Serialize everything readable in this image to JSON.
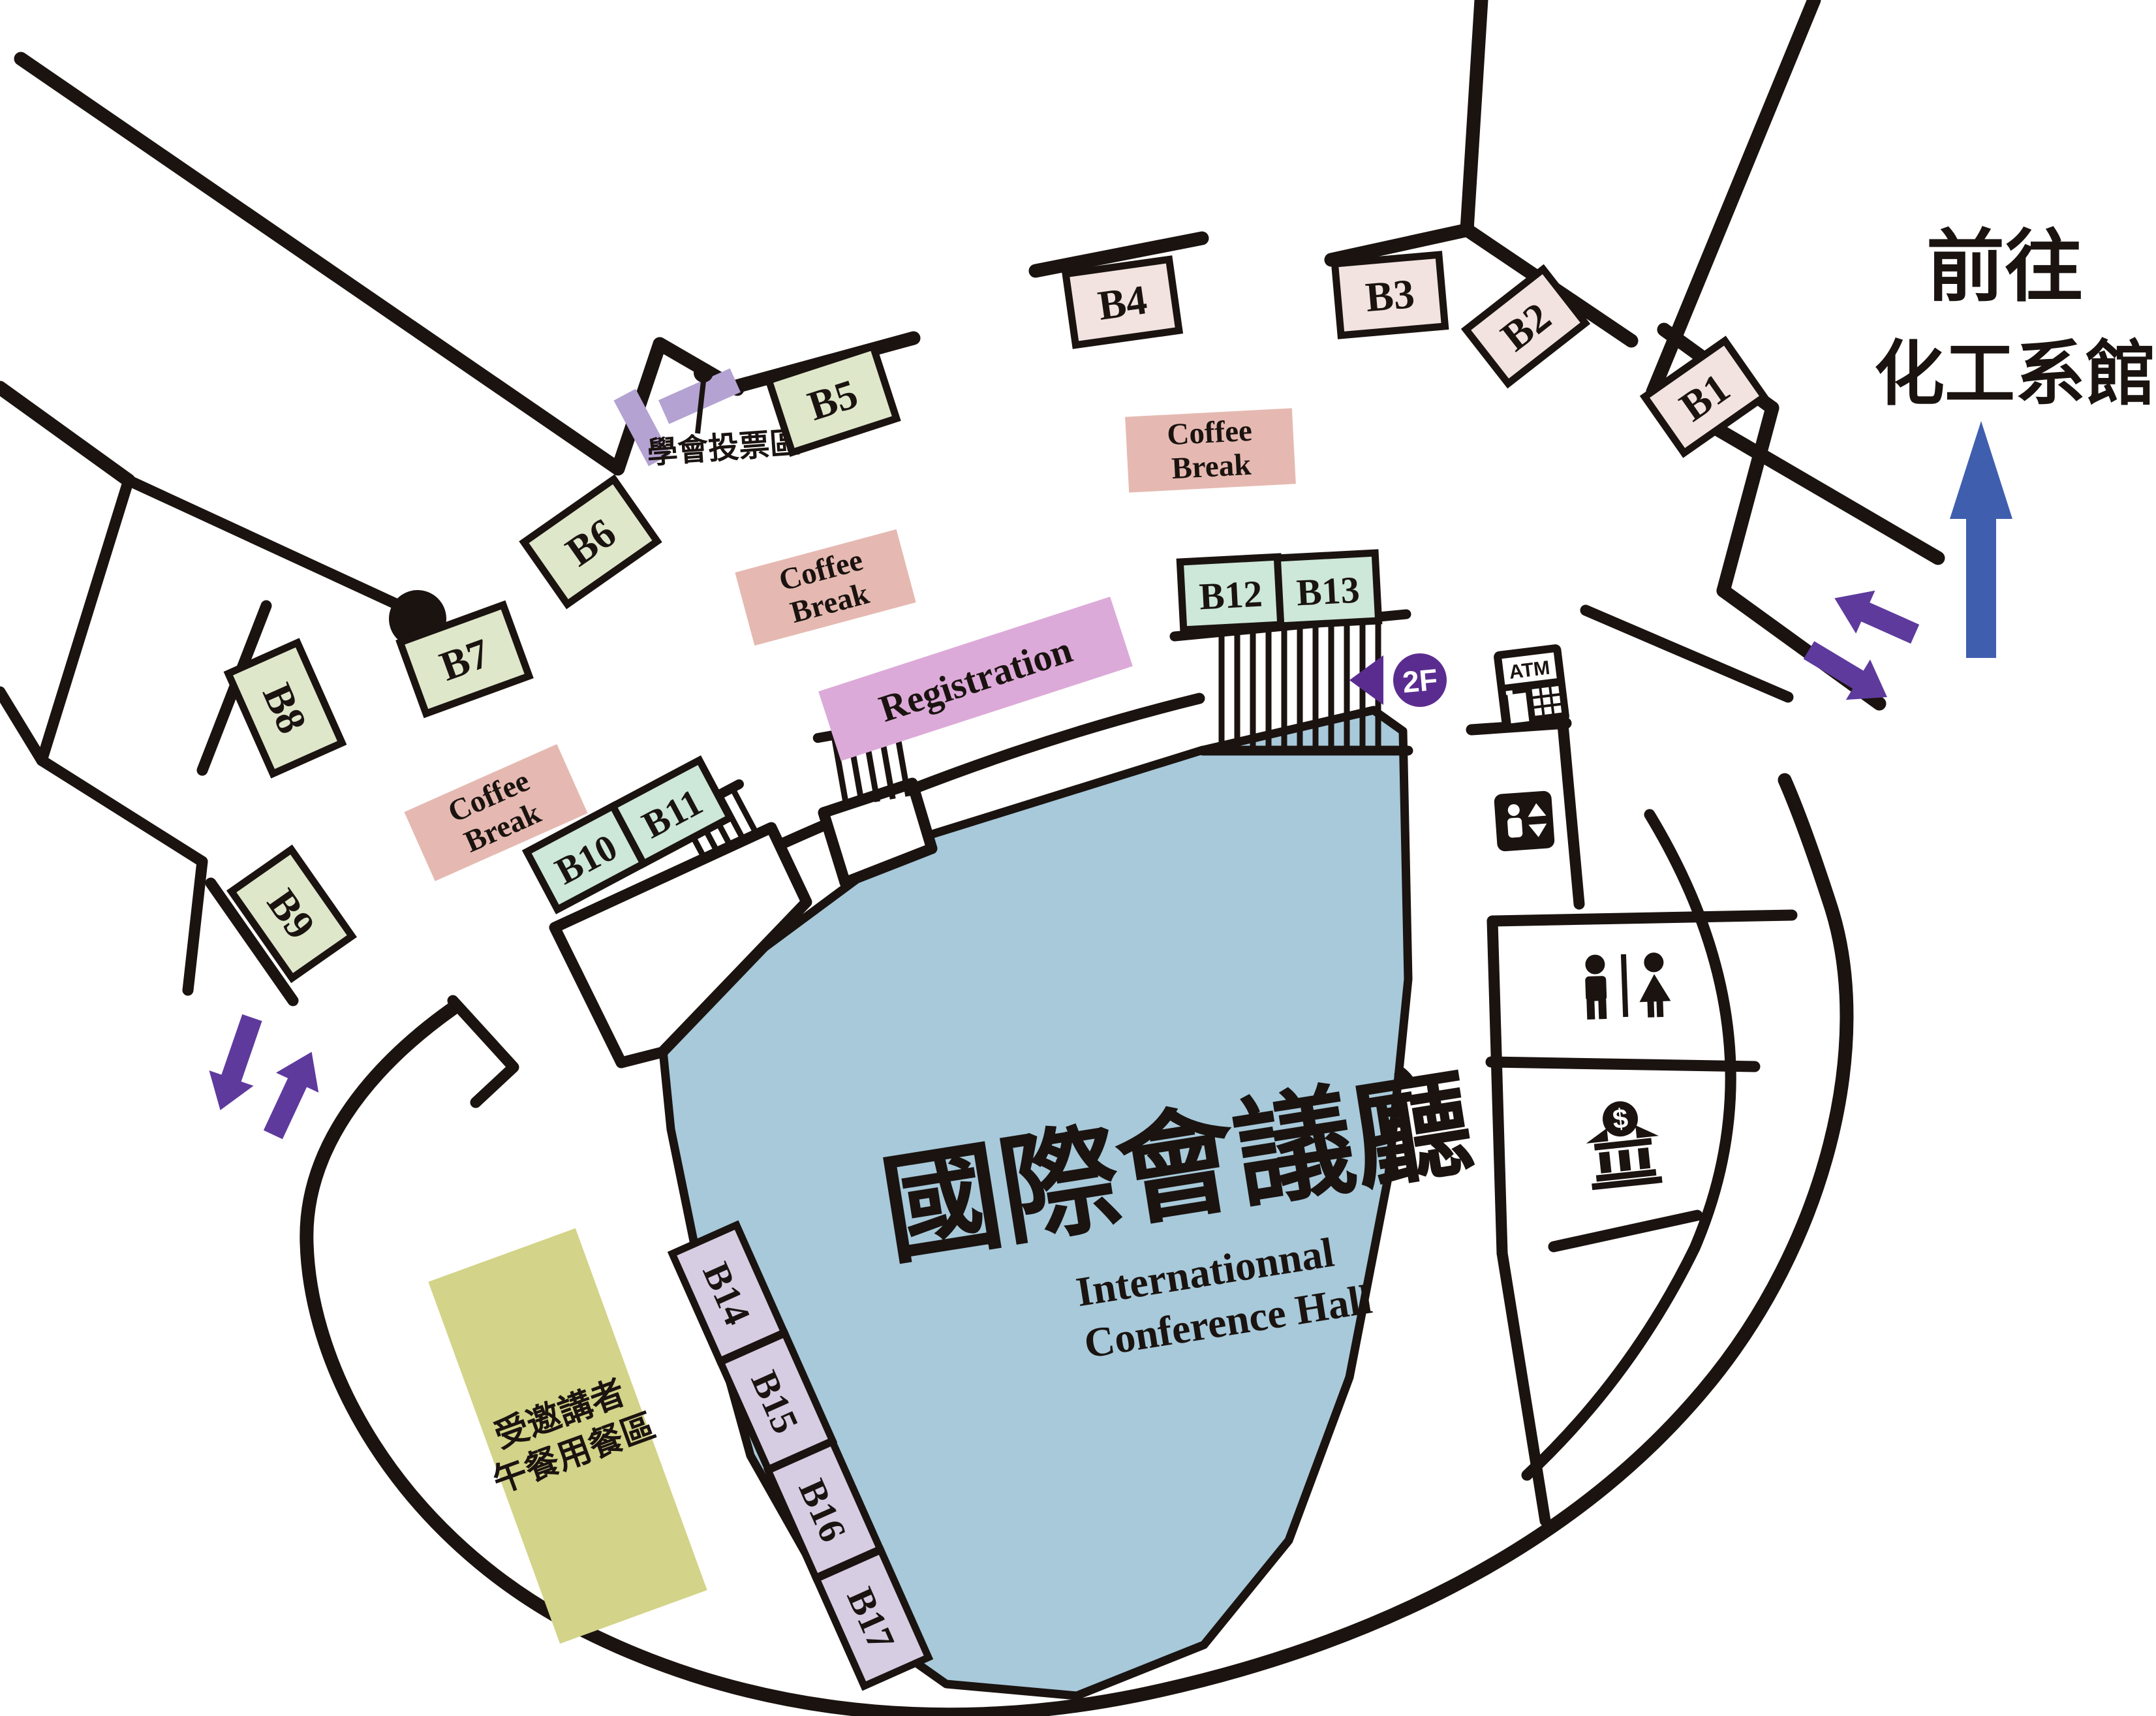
{
  "map": {
    "hall": {
      "title_zh": "國際會議廳",
      "title_en_line1": "Internationnal",
      "title_en_line2": "Conference Hall"
    },
    "direction_sign": {
      "line1": "前往",
      "line2": "化工系館"
    },
    "booths": [
      {
        "id": "B1",
        "label": "B1",
        "palette": "pink"
      },
      {
        "id": "B2",
        "label": "B2",
        "palette": "pink"
      },
      {
        "id": "B3",
        "label": "B3",
        "palette": "pink"
      },
      {
        "id": "B4",
        "label": "B4",
        "palette": "pink"
      },
      {
        "id": "B5",
        "label": "B5",
        "palette": "green"
      },
      {
        "id": "B6",
        "label": "B6",
        "palette": "green"
      },
      {
        "id": "B7",
        "label": "B7",
        "palette": "green"
      },
      {
        "id": "B8",
        "label": "B8",
        "palette": "green"
      },
      {
        "id": "B9",
        "label": "B9",
        "palette": "green"
      },
      {
        "id": "B10",
        "label": "B10",
        "palette": "mint"
      },
      {
        "id": "B11",
        "label": "B11",
        "palette": "mint"
      },
      {
        "id": "B12",
        "label": "B12",
        "palette": "mint"
      },
      {
        "id": "B13",
        "label": "B13",
        "palette": "mint"
      },
      {
        "id": "B14",
        "label": "B14",
        "palette": "lavender"
      },
      {
        "id": "B15",
        "label": "B15",
        "palette": "lavender"
      },
      {
        "id": "B16",
        "label": "B16",
        "palette": "lavender"
      },
      {
        "id": "B17",
        "label": "B17",
        "palette": "lavender"
      }
    ],
    "areas": {
      "coffee_break": {
        "line1": "Coffee",
        "line2": "Break"
      },
      "registration": "Registration",
      "voting": "學會投票區",
      "lunch": {
        "line1": "受邀講者",
        "line2": "午餐用餐區"
      }
    },
    "markers": {
      "floor_badge": "2F",
      "atm": "ATM"
    },
    "icons": [
      "atm-icon",
      "elevator-icon",
      "restroom-icon",
      "bank-icon",
      "stairs",
      "entrance-arrow-icon",
      "direction-arrow-icon",
      "pillar",
      "voting-pin-icon"
    ],
    "colors": {
      "wall": "#1a1310",
      "ink": "#1a1310",
      "hall_fill": "#a7c9da",
      "pink": "#f2e3e0",
      "green": "#dfe7ca",
      "mint": "#cde7d8",
      "lavender": "#d6cde2",
      "violet_booth": "#b3a2d2",
      "coffee": "#e5b9b1",
      "registration": "#dcaad8",
      "lunch": "#d3d389",
      "badge_purple": "#5b2c90",
      "arrow_purple": "#5e3a9d",
      "arrow_blue": "#3f5eae"
    }
  }
}
